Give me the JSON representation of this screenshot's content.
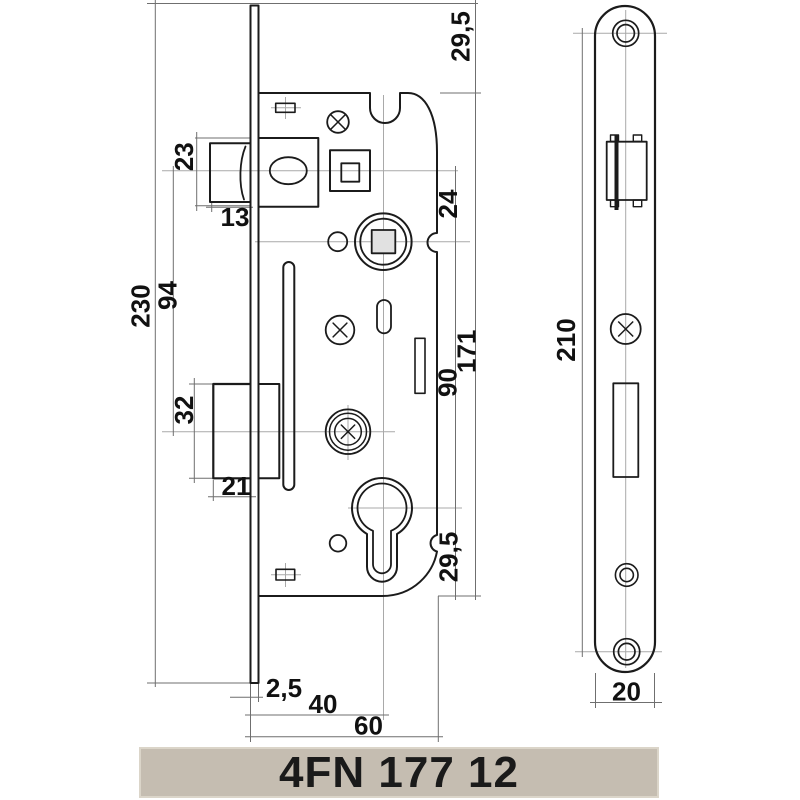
{
  "product": {
    "code": "4FN 177 12"
  },
  "colors": {
    "outline": "#1b1b1b",
    "dimension_lines": "#6f6f6f",
    "centerlines": "#a9a9a9",
    "label_text": "#111111",
    "hub_square_fill": "#e1e1e1",
    "bar_background": "#c5bdb1",
    "bar_border": "#dbd5c9",
    "bar_text": "#1a1a1a",
    "page_background": "#ffffff"
  },
  "side_view": {
    "dimensions": {
      "latch_height": "23",
      "latch_protrusion": "13",
      "total_height": "230",
      "latch_to_deadbolt_axis": "94",
      "deadbolt_height": "32",
      "deadbolt_protrusion": "21",
      "latch_to_follower_axis": "24",
      "case_height": "171",
      "follower_to_cylinder_axis": "90",
      "plate_top_to_case": "29,5",
      "cylinder_axis_to_case_bottom": "29,5",
      "plate_thickness": "2,5",
      "backset": "40",
      "case_depth": "60"
    }
  },
  "front_view": {
    "dimensions": {
      "screw_hole_spacing": "210",
      "plate_width": "20"
    }
  }
}
